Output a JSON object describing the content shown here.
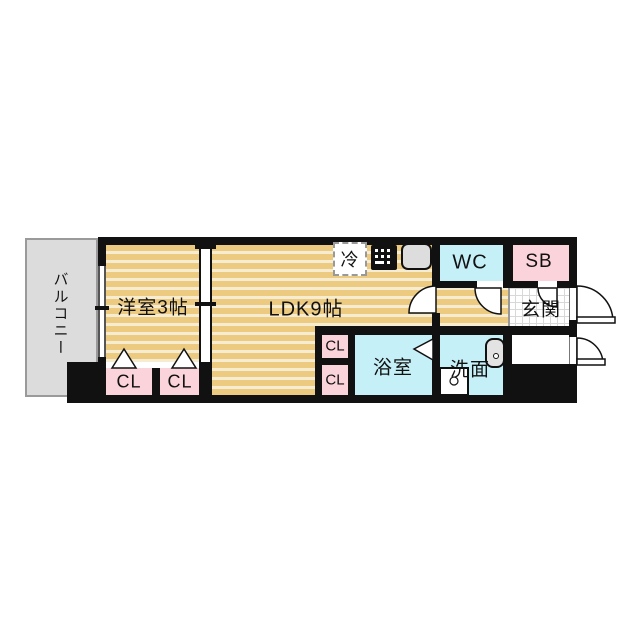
{
  "floor_plan": {
    "balcony": {
      "label": "バルコニー"
    },
    "western_room": {
      "label": "洋室3帖"
    },
    "ldk": {
      "label": "LDK9帖"
    },
    "refrigerator": {
      "label": "冷"
    },
    "wc": {
      "label": "WC"
    },
    "shoe_box": {
      "label": "SB"
    },
    "entrance": {
      "label": "玄関"
    },
    "bathroom": {
      "label": "浴室"
    },
    "washroom": {
      "label": "洗面"
    },
    "closet_left_1": {
      "label": "CL"
    },
    "closet_left_2": {
      "label": "CL"
    },
    "closet_mid_upper": {
      "label": "CL"
    },
    "closet_mid_lower": {
      "label": "CL"
    },
    "colors": {
      "flooring_stripe_dark": "#ecca80",
      "flooring_stripe_light": "#f6ecd2",
      "wet_area_cyan": "#c6f0f7",
      "closet_pink": "#fad4da",
      "balcony_gray": "#dcdcdc",
      "entrance_tile_line": "#d8d8d8",
      "wall_black": "#111111"
    }
  }
}
